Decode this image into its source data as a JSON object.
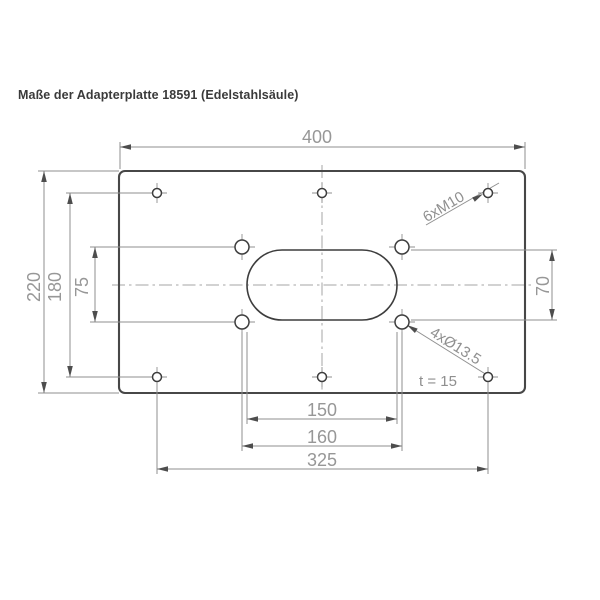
{
  "title": "Maße der Adapterplatte 18591 (Edelstahlsäule)",
  "dimensions": {
    "plate_width": "400",
    "plate_height": "220",
    "outer_hole_row_spacing": "180",
    "inner_hole_row_spacing": "75",
    "slot_height": "70",
    "slot_length": "150",
    "inner_hole_col_spacing": "160",
    "outer_hole_col_spacing": "325"
  },
  "labels": {
    "threaded_holes": "6xM10",
    "through_holes": "4xØ13.5",
    "plate_thickness": "t = 15"
  },
  "colors": {
    "outline": "#474747",
    "dimension_lines": "#8f8f8f",
    "dimension_text": "#979797",
    "title_text": "#3a3a3a"
  }
}
